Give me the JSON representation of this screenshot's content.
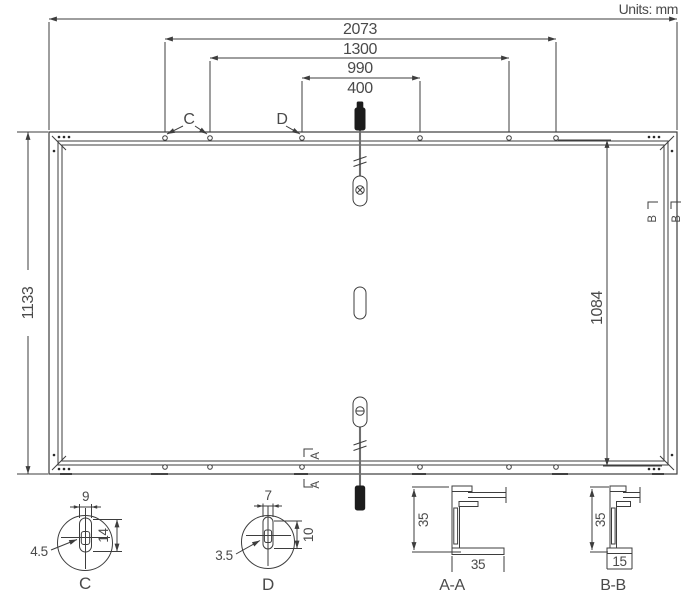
{
  "title": {
    "units_label": "Units: mm"
  },
  "main_view": {
    "dim_overall_length": "2073",
    "dim_hole_spacing_outer": "1300",
    "dim_hole_spacing_middle": "990",
    "dim_hole_spacing_inner": "400",
    "dim_overall_width": "1133",
    "dim_inner_length": "1084",
    "callout_c": "C",
    "callout_d": "D",
    "section_marker_a": "A",
    "section_marker_b": "B"
  },
  "detail_c": {
    "label": "C",
    "dim_slot_width": "9",
    "dim_slot_length": "14",
    "dim_radius": "4.5"
  },
  "detail_d": {
    "label": "D",
    "dim_slot_width": "7",
    "dim_slot_length": "10",
    "dim_radius": "3.5"
  },
  "section_aa": {
    "label": "A-A",
    "dim_height": "35",
    "dim_width": "35"
  },
  "section_bb": {
    "label": "B-B",
    "dim_height": "35",
    "dim_width": "15"
  }
}
